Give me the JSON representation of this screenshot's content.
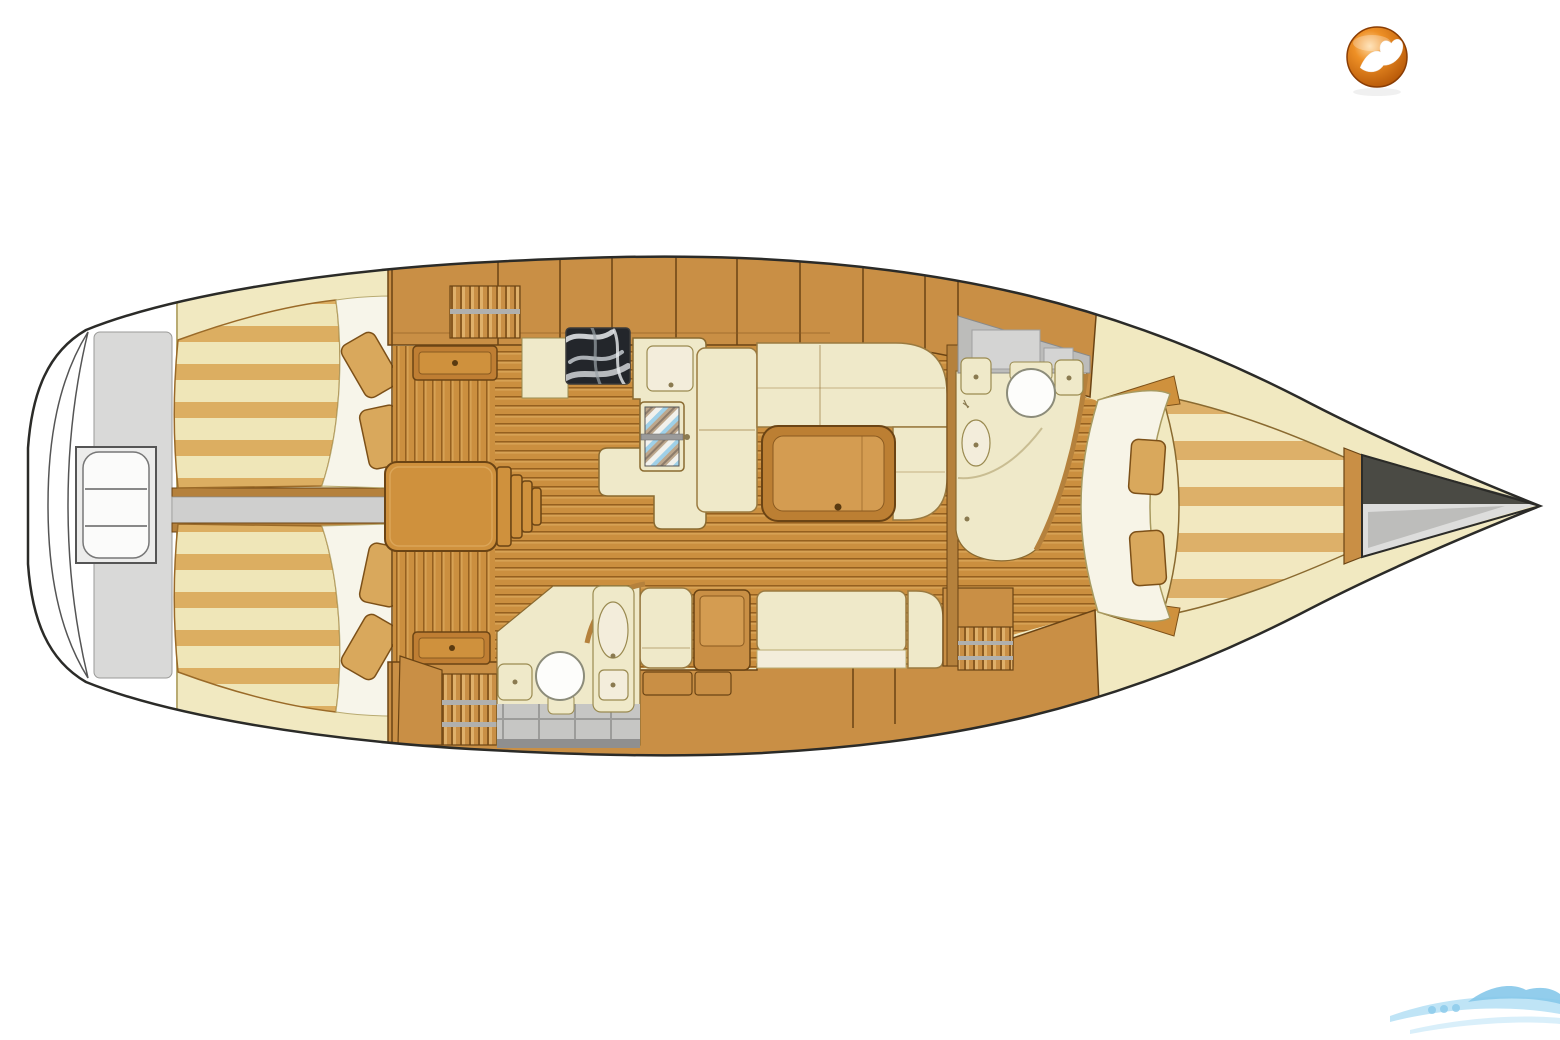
{
  "meta": {
    "content_type": "sailboat-interior-floor-plan",
    "view": "top-down-deck-plan",
    "visible_text": []
  },
  "palette": {
    "hullLine": "#2b2b28",
    "deckWhite": "#ffffff",
    "deckGray": "#d9d9d8",
    "deckCream": "#f1e9c1",
    "bandLine": "#b9ab72",
    "wood": "#c98f45",
    "woodDark": "#6b4414",
    "woodLight": "#dfb06a",
    "woodTrim": "#b5813c",
    "floor": "#cb8f3f",
    "floorLine": "#95601f",
    "floorHi": "#e6b96d",
    "berthCream": "#efe6b8",
    "berthTan": "#dcae61",
    "vberthCream": "#f2e8c0",
    "vberthTan": "#ddb069",
    "cushion": "#efe9c9",
    "cushionLine": "#9a7a40",
    "cushionLight": "#f3eddb",
    "pillow": "#d9a85c",
    "pillowLine": "#7c5018",
    "steps": "#cf913d",
    "tableOuter": "#bc7f33",
    "tableInner": "#d49c51",
    "marble": "#23262b",
    "marbleStreak": "#e9ecef",
    "tile": "#c6c6c4",
    "tileGap": "#9c9c9a",
    "tileDark": "#8f8f8f",
    "metal": "#9b9b9b",
    "fixWhite": "#fdfdfb",
    "fixLine": "#8c8c7a",
    "anchorDark": "#4a4a44",
    "anchorMid": "#bdbdbb",
    "anchorLight": "#dddddc",
    "logoOrange": "#ee9026",
    "logoDeep": "#b35405",
    "logoRing": "#8a3d04",
    "wmBlue": "#bfe4f6",
    "wmBlue2": "#86c8ea"
  },
  "logo": {
    "name": "marketplace-logo",
    "shape": "orange-sphere-with-white-bird-glyph",
    "position": "top-right"
  },
  "watermark": {
    "name": "marketplace-watermark",
    "shape": "light-blue-wave-swoosh",
    "position": "bottom-right"
  },
  "regions": [
    {
      "id": "swim-platform",
      "label": "swim platform"
    },
    {
      "id": "transom-deck",
      "label": "stern deck"
    },
    {
      "id": "helm-seat",
      "label": "helm seat"
    },
    {
      "id": "aft-berth-starboard",
      "label": "aft cabin berth (starboard)"
    },
    {
      "id": "aft-berth-port",
      "label": "aft cabin berth (port)"
    },
    {
      "id": "aft-corridor",
      "label": "center corridor / engine space"
    },
    {
      "id": "companionway-steps",
      "label": "companionway steps"
    },
    {
      "id": "galley",
      "label": "galley with stove and sink"
    },
    {
      "id": "salon",
      "label": "salon with table and settees"
    },
    {
      "id": "aft-head",
      "label": "aft head with toilet and shower"
    },
    {
      "id": "fwd-head",
      "label": "forward head with toilet and shower"
    },
    {
      "id": "v-berth",
      "label": "forward V-berth cabin"
    },
    {
      "id": "anchor-locker",
      "label": "forepeak anchor locker"
    }
  ]
}
